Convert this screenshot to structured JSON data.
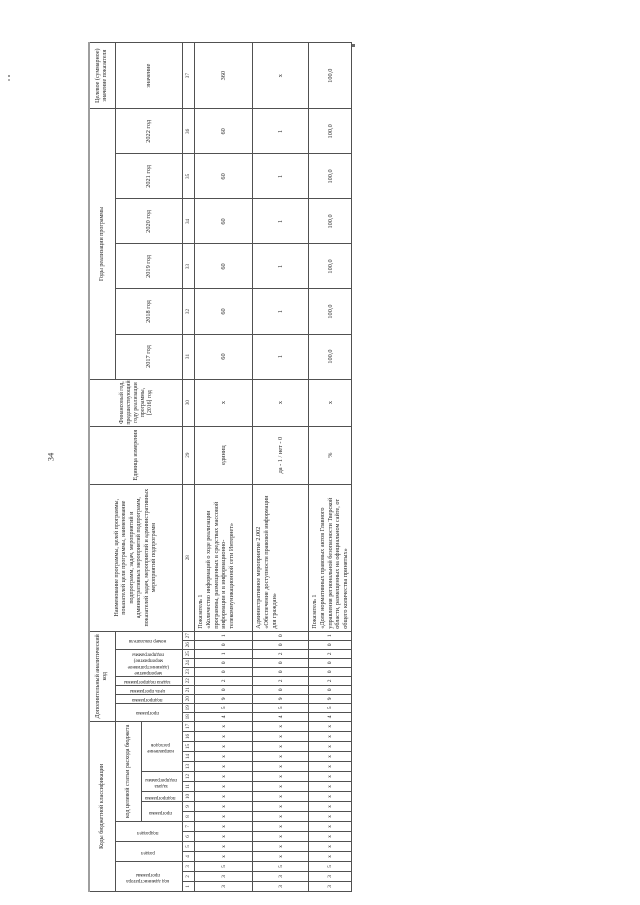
{
  "page": {
    "number": "34"
  },
  "table": {
    "header": {
      "budget_codes_title": "Коды бюджетной классификации",
      "admin_code": "код администратора программы",
      "razdel": "раздел",
      "podrazdel": "подраздел",
      "target_article_title": "код целевой статьи расхода бюджета",
      "ta_programma": "программа",
      "ta_podprogramma": "подпрограмма",
      "ta_zadacha": "задача подпрограммы",
      "ta_napravlenie": "направление расходов",
      "analytic_title": "Дополнительный аналитический код",
      "an_programma": "программа",
      "an_podprogramma": "подпрограмма",
      "an_tsel": "цель программы",
      "an_zadacha": "задача подпрограммы",
      "an_meropriyatie": "мероприятие (административное мероприятие) подпрограммы",
      "an_nomer": "номер показателя",
      "name_title": "Наименование программы, целей программы, показателей цели программы, наименование подпрограмм, задач, мероприятий и административных мероприятий подпрограмм, показателей задач, мероприятий и административных мероприятий подпрограмм",
      "unit_title": "Единица измерения",
      "base_year_title": "Финансовый год, предшествующий году реализации программы, [2016] год",
      "years_title": "Годы реализации программы",
      "years": [
        "2017 год",
        "2018 год",
        "2019 год",
        "2020 год",
        "2021 год",
        "2022 год"
      ],
      "target_title": "Целевое (суммарное) значение показателя",
      "target_sub": "значение"
    },
    "column_numbers": [
      "1",
      "2",
      "3",
      "4",
      "5",
      "6",
      "7",
      "8",
      "9",
      "10",
      "11",
      "12",
      "13",
      "14",
      "15",
      "16",
      "17",
      "18",
      "19",
      "20",
      "21",
      "22",
      "23",
      "24",
      "25",
      "26",
      "27",
      "28",
      "29",
      "30",
      "31",
      "32",
      "33",
      "34",
      "35",
      "36",
      "37"
    ],
    "rows": [
      {
        "cells": [
          "3",
          "3",
          "5",
          "х",
          "х",
          "х",
          "х",
          "х",
          "х",
          "х",
          "х",
          "х",
          "х",
          "х",
          "х",
          "х",
          "х",
          "4",
          "5",
          "9",
          "0",
          "2",
          "0",
          "0",
          "1",
          "0",
          "1",
          "Показатель 1\n«Количество информаций о ходе реализации программы, размещенных в средствах массовой информации и в информационно-телекоммуникационной сети Интернет»",
          "единиц",
          "х",
          "60",
          "60",
          "60",
          "60",
          "60",
          "60",
          "360"
        ]
      },
      {
        "cells": [
          "3",
          "3",
          "5",
          "х",
          "х",
          "х",
          "х",
          "х",
          "х",
          "х",
          "х",
          "х",
          "х",
          "х",
          "х",
          "х",
          "х",
          "4",
          "5",
          "9",
          "0",
          "2",
          "0",
          "0",
          "2",
          "0",
          "0",
          "Административное мероприятие 2.002\n«Обеспечение доступности правовой информации для граждан»",
          "да - 1 / нет - 0",
          "х",
          "1",
          "1",
          "1",
          "1",
          "1",
          "1",
          "х"
        ]
      },
      {
        "cells": [
          "3",
          "3",
          "5",
          "х",
          "х",
          "х",
          "х",
          "х",
          "х",
          "х",
          "х",
          "х",
          "х",
          "х",
          "х",
          "х",
          "х",
          "4",
          "5",
          "9",
          "0",
          "2",
          "0",
          "0",
          "2",
          "0",
          "1",
          "Показатель 1\n«Доля нормативных правовых актов Главного управления региональной безопасности Тверской области, размещенных на официальном сайте, от общего количества принятых»",
          "%",
          "х",
          "100,0",
          "100,0",
          "100,0",
          "100,0",
          "100,0",
          "100,0",
          "100,0"
        ]
      }
    ]
  }
}
